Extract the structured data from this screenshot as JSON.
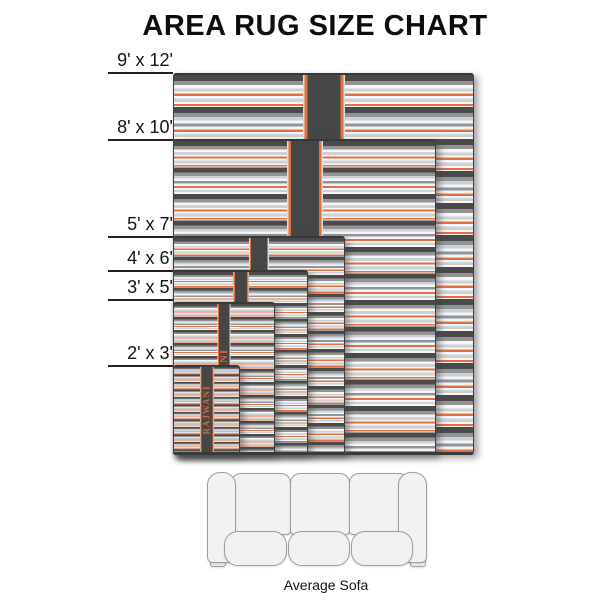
{
  "title": "AREA RUG SIZE CHART",
  "brand": "RAJWANI",
  "rugs": [
    {
      "label": "9' x 12'",
      "width_ft": 9,
      "length_ft": 12
    },
    {
      "label": "8' x 10'",
      "width_ft": 8,
      "length_ft": 10
    },
    {
      "label": "5' x 7'",
      "width_ft": 5,
      "length_ft": 7
    },
    {
      "label": "4' x 6'",
      "width_ft": 4,
      "length_ft": 6
    },
    {
      "label": "3' x 5'",
      "width_ft": 3,
      "length_ft": 5
    },
    {
      "label": "2' x 3'",
      "width_ft": 2,
      "length_ft": 3
    }
  ],
  "sofa": {
    "label": "Average Sofa"
  },
  "colors": {
    "stripe_dark": "#4a4a4a",
    "stripe_gray": "#949494",
    "stripe_light_gray": "#ccd1d8",
    "stripe_white": "#f6f6f6",
    "stripe_orange": "#e4703f",
    "band_dark": "#464646",
    "brand_text": "#c96a3e",
    "sofa_fill": "#f2f2f2",
    "sofa_outline": "#9e9e9e",
    "text": "#0d0d0d",
    "background": "#ffffff"
  }
}
